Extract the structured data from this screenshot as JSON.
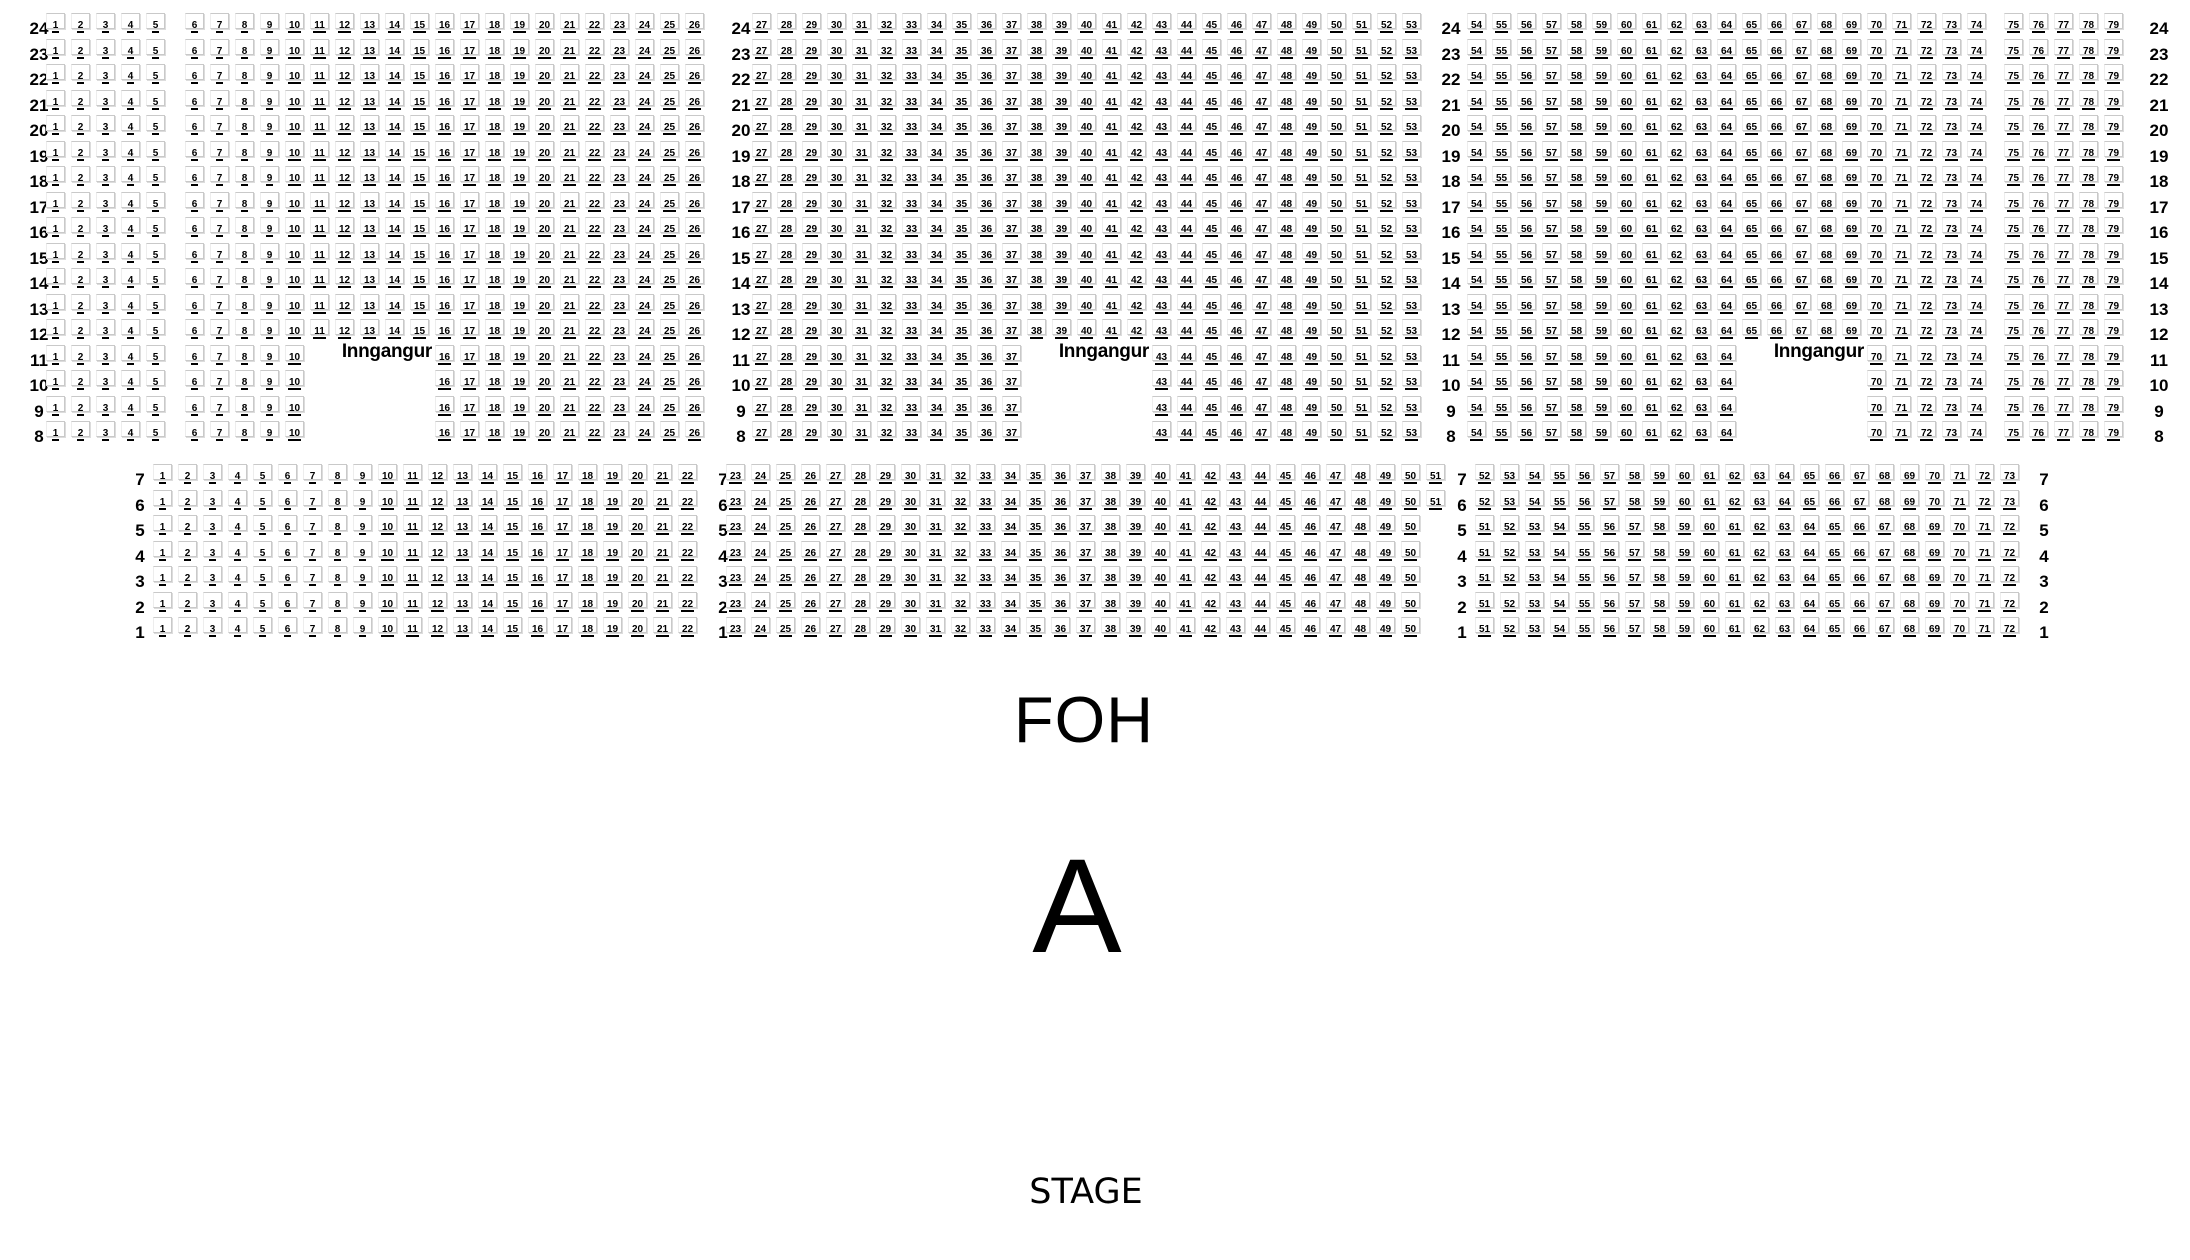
{
  "labels": {
    "foh": "FOH",
    "section_letter": "A",
    "stage": "STAGE"
  },
  "upper_section": {
    "groups": [
      {
        "labels": [
          "24",
          "23",
          "22",
          "21",
          "20",
          "19",
          "18",
          "17",
          "16",
          "15",
          "14",
          "13",
          "12"
        ],
        "blocks": [
          [
            [
              1,
              5
            ],
            [
              6,
              26
            ]
          ],
          [
            [
              27,
              53
            ]
          ],
          [
            [
              54,
              74
            ],
            [
              75,
              79
            ]
          ]
        ]
      },
      {
        "labels": [
          "11",
          "10",
          "9",
          "8"
        ],
        "blocks": [
          [
            [
              1,
              5
            ],
            [
              6,
              10
            ],
            [
              16,
              26
            ]
          ],
          [
            [
              27,
              37
            ],
            [
              43,
              53
            ]
          ],
          [
            [
              54,
              64
            ],
            [
              70,
              74
            ],
            [
              75,
              79
            ]
          ]
        ]
      }
    ],
    "entrances": [
      {
        "label": "Inngangur"
      },
      {
        "label": "Inngangur"
      },
      {
        "label": "Inngangur"
      }
    ]
  },
  "lower_section": {
    "groups": [
      {
        "labels": [
          "7",
          "6"
        ],
        "blocks": [
          [
            [
              1,
              22
            ]
          ],
          [
            [
              23,
              51
            ]
          ],
          [
            [
              52,
              73
            ]
          ]
        ]
      },
      {
        "labels": [
          "5",
          "4",
          "3",
          "2",
          "1"
        ],
        "blocks": [
          [
            [
              1,
              22
            ]
          ],
          [
            [
              23,
              50
            ]
          ],
          [
            [
              51,
              72
            ]
          ]
        ]
      }
    ]
  }
}
